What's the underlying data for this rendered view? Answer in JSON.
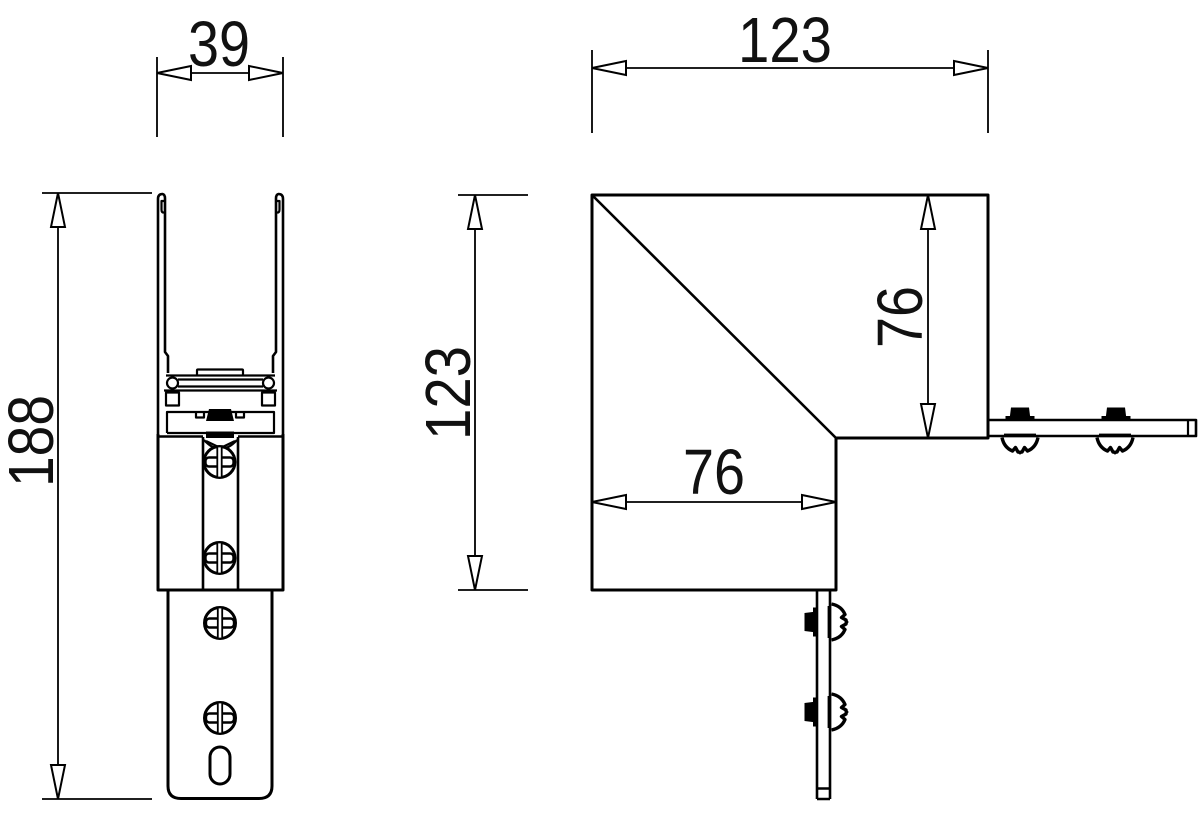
{
  "meta": {
    "background": "#ffffff",
    "line_color": "#000000",
    "text_color": "#111111",
    "drawing_type": "bracket dimension drawing, two orthographic views"
  },
  "dims": {
    "front_width": "39",
    "front_height": "188",
    "side_width": "123",
    "side_height": "123",
    "side_inner_height": "76",
    "side_inner_width": "76"
  }
}
